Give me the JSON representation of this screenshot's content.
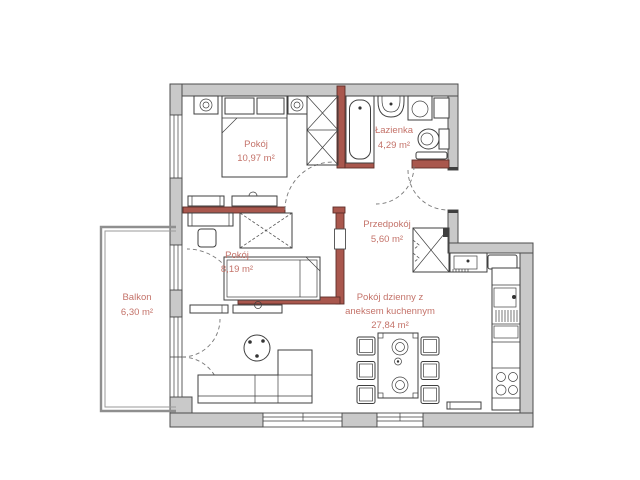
{
  "plan": {
    "rooms": [
      {
        "id": "bedroom-1",
        "lines": [
          "Pokój",
          "10,97 m²"
        ]
      },
      {
        "id": "bathroom",
        "lines": [
          "Łazienka",
          "4,29 m²"
        ]
      },
      {
        "id": "hallway",
        "lines": [
          "Przedpokój",
          "5,60 m²"
        ]
      },
      {
        "id": "bedroom-2",
        "lines": [
          "Pokój",
          "8,19 m²"
        ]
      },
      {
        "id": "living-room-kitchenette",
        "lines": [
          "Pokój dzienny z",
          "aneksem kuchennym",
          "27,84 m²"
        ]
      },
      {
        "id": "balcony",
        "lines": [
          "Balkon",
          "6,30 m²"
        ]
      }
    ],
    "colors": {
      "wall": "#c9c9c9",
      "accent": "#a9574d",
      "label": "#c4736a"
    }
  }
}
